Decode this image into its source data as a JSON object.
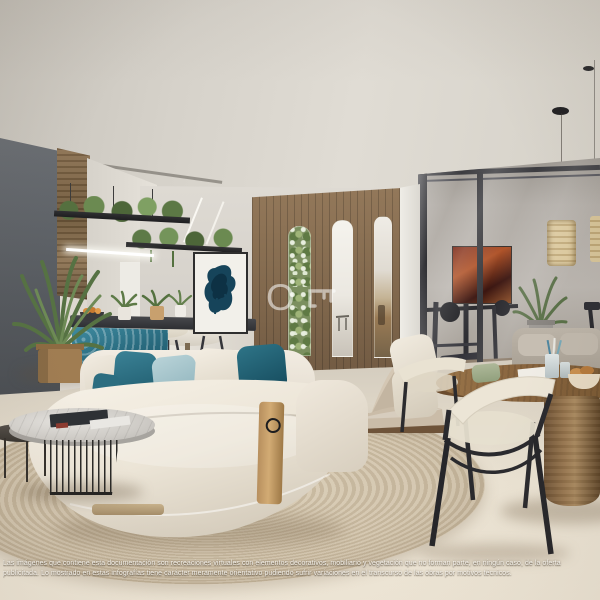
{
  "watermark": {
    "letter": "O",
    "icon_name": "key-icon"
  },
  "disclaimer": {
    "line1": "Las imágenes que contiene esta documentación son recreaciones virtuales con elementos decorativos, mobiliario y vegetación que no forman parte, en ningún caso, de la oferta",
    "line2": "publicitada. Lo mostrado en estas infografías tiene carácter meramente orientativo pudiendo sufrir variaciones en el transcurso de las obras por motivos técnicos."
  },
  "palette": {
    "ceiling": "#d8d4cc",
    "dark_wall": "#585c61",
    "partition_wood": "#856c50",
    "teal_accent": "#2a6c80",
    "sofa_boucle": "#efe9de",
    "rug": "#cfc0a6",
    "floor": "#ece4d4",
    "glass_frame": "#3a3a3e",
    "watermark_white": "rgba(255,255,255,0.5)"
  }
}
